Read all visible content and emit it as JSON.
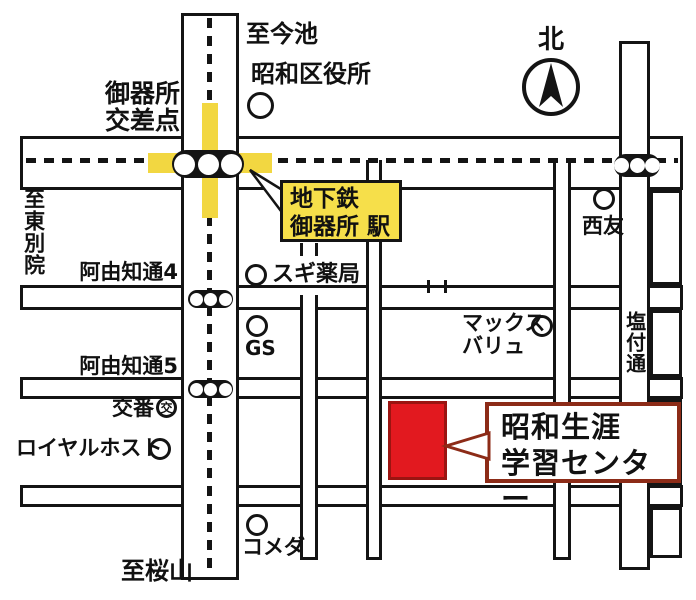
{
  "compass": {
    "north_label": "北"
  },
  "roads": {
    "to_imaike": "至今池",
    "to_higashibetsuin": "至東別院",
    "to_sakurayama": "至桜山",
    "ayuchi4": "阿由知通4",
    "ayuchi5": "阿由知通5",
    "shiotsuke": "塩付通",
    "gokiso_intersection_line1": "御器所",
    "gokiso_intersection_line2": "交差点"
  },
  "station": {
    "line1": "地下鉄",
    "line2": "御器所 駅"
  },
  "landmarks": {
    "ward_office": "昭和区役所",
    "sugi_pharmacy": "スギ薬局",
    "seiyu": "西友",
    "gs": "GS",
    "maxvalu_line1": "マックス",
    "maxvalu_line2": "バリュ",
    "koban_label": "交番",
    "koban_symbol": "交",
    "royal_host": "ロイヤルホスト",
    "komeda": "コメダ"
  },
  "destination": {
    "line1": "昭和生涯",
    "line2": "学習センター"
  },
  "icons": {
    "compass": "north-arrow-icon",
    "station_signal": "station-signal-icon",
    "landmark": "landmark-circle-icon",
    "police_box": "koban-circle-icon"
  },
  "colors": {
    "highlight_yellow": "#f2d741",
    "station_yellow": "#f6df4a",
    "destination_red": "#e2191f",
    "destination_red_border": "#9b1411",
    "callout_border": "#8c2b17",
    "line_black": "#141414"
  }
}
